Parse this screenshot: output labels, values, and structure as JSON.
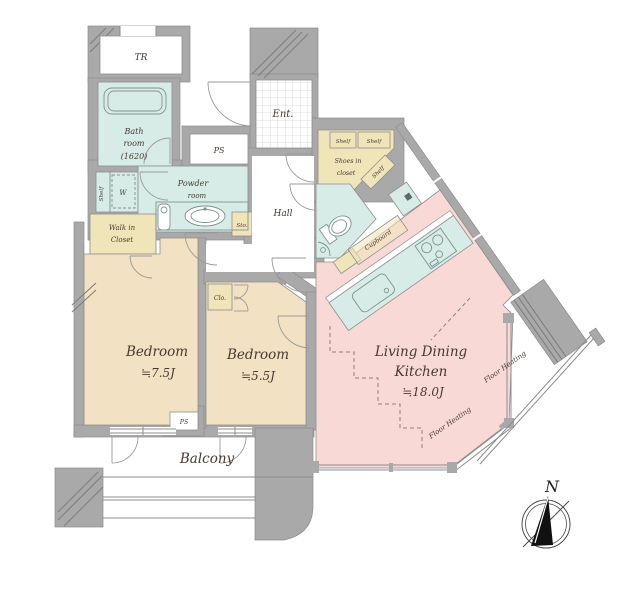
{
  "plan_type": "apartment-floor-plan",
  "colors": {
    "wall": "#a9a9a9",
    "wall_dark": "#8d8d8d",
    "outline": "#8f8f8f",
    "fixture": "#7e938e",
    "bedroom": "#f2e1c2",
    "ldk": "#f9d9d6",
    "wet": "#d8ece7",
    "closet": "#f0e5b8",
    "heat_line": "#93807b",
    "text": "#453a31"
  },
  "rooms": {
    "tr": {
      "name": "TR"
    },
    "bath": {
      "line1": "Bath",
      "line2": "room",
      "line3": "(1620)"
    },
    "ps_upper": {
      "name": "PS"
    },
    "powder": {
      "line1": "Powder",
      "line2": "room"
    },
    "shelf_w_nook": {
      "shelf": "Shelf",
      "washer": "W"
    },
    "walk_in_closet": {
      "line1": "Walk in",
      "line2": "Closet"
    },
    "storage": {
      "name": "Sto."
    },
    "entrance": {
      "name": "Ent."
    },
    "hall": {
      "name": "Hall"
    },
    "shoes_closet": {
      "line1": "Shoes in",
      "line2": "closet",
      "shelf_left": "Shelf",
      "shelf_right": "Shelf",
      "shelf_diag": "Shelf"
    },
    "cupboard": {
      "name": "Cupboard"
    },
    "closet_small": {
      "name": "Clo."
    },
    "bedroom1": {
      "name": "Bedroom",
      "size": "≒7.5J"
    },
    "bedroom2": {
      "name": "Bedroom",
      "size": "≒5.5J"
    },
    "ldk": {
      "line1": "Living Dining",
      "line2": "Kitchen",
      "size": "≒18.0J"
    },
    "floor_heating_lower": {
      "name": "Floor Heating"
    },
    "floor_heating_upper": {
      "name": "Floor Heating"
    },
    "balcony": {
      "name": "Balcony"
    },
    "ps_lower": {
      "name": "PS"
    }
  },
  "compass": {
    "north": "N"
  }
}
